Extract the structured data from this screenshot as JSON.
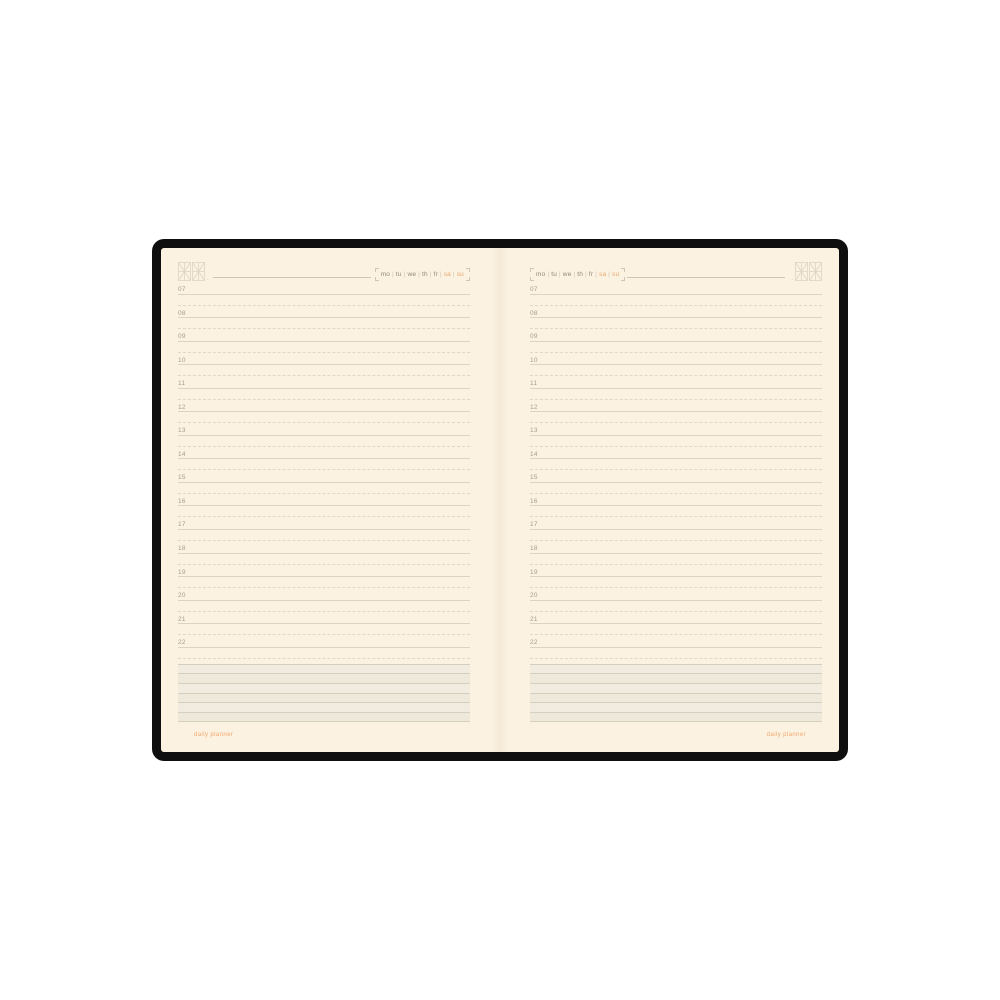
{
  "product": {
    "type": "open-daily-planner-spread",
    "cover_color": "#0f0f0f",
    "page_color": "#fcf2e1"
  },
  "header": {
    "weekdays": [
      "mo",
      "tu",
      "we",
      "th",
      "fr",
      "sa",
      "su"
    ],
    "weekend_days": [
      "sa",
      "su"
    ],
    "separator": "|",
    "weekday_color": "#8f897d",
    "weekend_color": "#e5a76f",
    "date_dot": "."
  },
  "schedule": {
    "hours": [
      "07",
      "08",
      "09",
      "10",
      "11",
      "12",
      "13",
      "14",
      "15",
      "16",
      "17",
      "18",
      "19",
      "20",
      "21",
      "22"
    ],
    "label_color": "#a59d8f",
    "rule_color": "#dcd4c2"
  },
  "notes": {
    "rows": 6,
    "band_color": "#f1ecdf",
    "line_color": "#d6cfbd"
  },
  "footer": {
    "label": "daily planner",
    "color": "#f0a76d"
  }
}
